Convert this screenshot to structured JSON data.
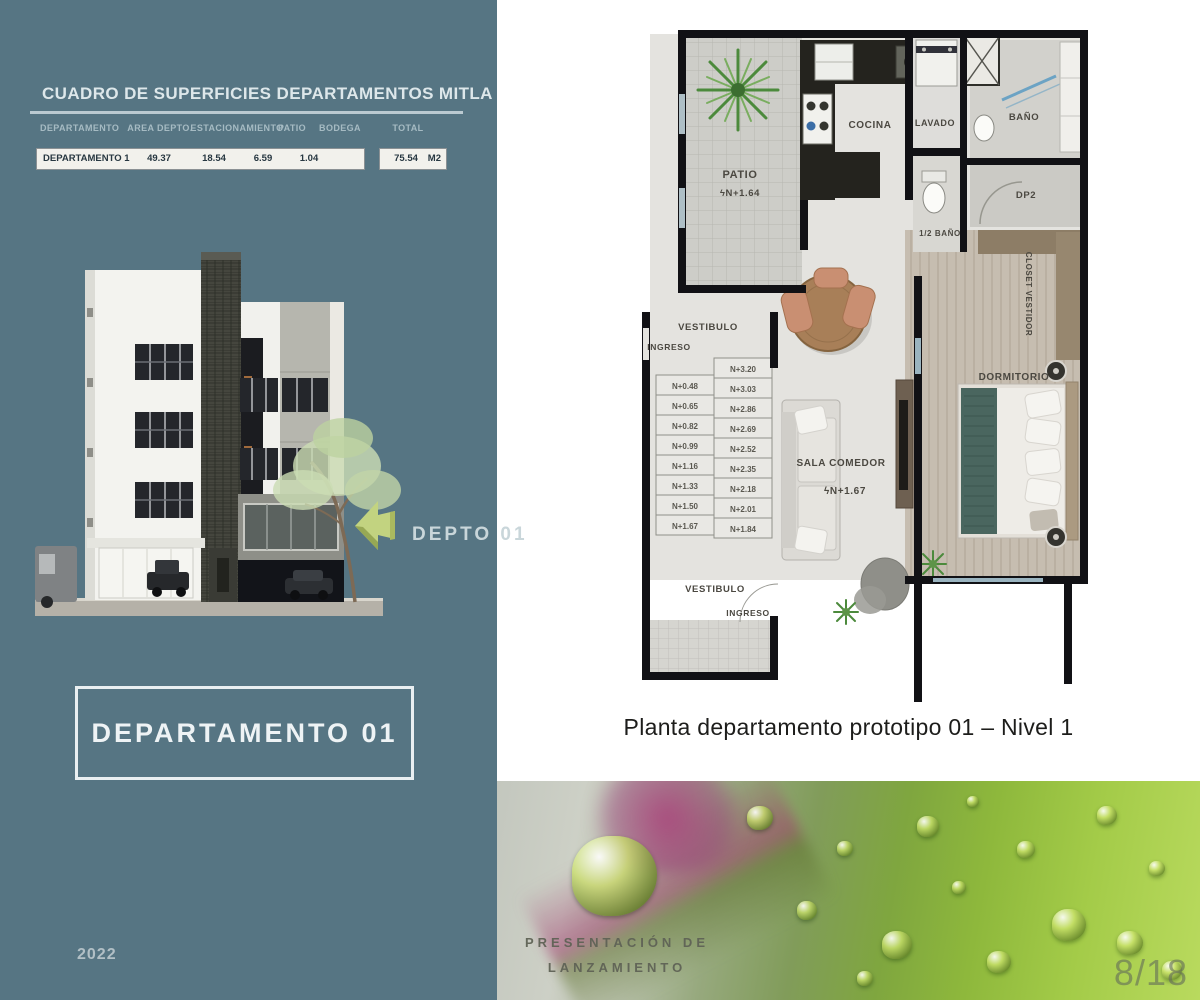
{
  "left_panel": {
    "table": {
      "title": "CUADRO DE SUPERFICIES DEPARTAMENTOS MITLA",
      "headers": [
        "DEPARTAMENTO",
        "AREA DEPTO.",
        "ESTACIONAMIENTO",
        "PATIO",
        "BODEGA",
        "TOTAL"
      ],
      "row": {
        "name": "DEPARTAMENTO 1",
        "area": "49.37",
        "estacionamiento": "18.54",
        "patio": "6.59",
        "bodega": "1.04"
      },
      "total_value": "75.54",
      "total_unit": "M2"
    },
    "callout_label": "DEPTO 01",
    "title_box": "DEPARTAMENTO 01",
    "year": "2022"
  },
  "floor_plan": {
    "caption": "Planta departamento prototipo 01 – Nivel 1",
    "labels": {
      "patio": "PATIO",
      "patio_level": "ϟN+1.64",
      "cocina": "COCINA",
      "lavado": "LAVADO",
      "bano": "BAÑO",
      "medio_bano": "1/2 BAÑO",
      "dp2": "DP2",
      "closet": "CLOSET VESTIDOR",
      "dormitorio": "DORMITORIO",
      "vestibulo_sup": "VESTIBULO",
      "ingreso_sup": "INGRESO",
      "vestibulo_inf": "VESTIBULO",
      "ingreso_inf": "INGRESO",
      "sala": "SALA COMEDOR",
      "sala_level": "ϟN+1.67"
    },
    "stairs_left": [
      "N+0.48",
      "N+0.65",
      "N+0.82",
      "N+0.99",
      "N+1.16",
      "N+1.33",
      "N+1.50",
      "N+1.67"
    ],
    "stairs_right": [
      "N+3.20",
      "N+3.03",
      "N+2.86",
      "N+2.69",
      "N+2.52",
      "N+2.35",
      "N+2.18",
      "N+2.01",
      "N+1.84"
    ]
  },
  "photo": {
    "overlay_line1": "PRESENTACIÓN DE",
    "overlay_line2": "LANZAMIENTO",
    "page_number": "8/18"
  },
  "colors": {
    "panel_teal": "#567583",
    "arrow_green": "#c2d380",
    "accent_white": "#eef3f5"
  }
}
